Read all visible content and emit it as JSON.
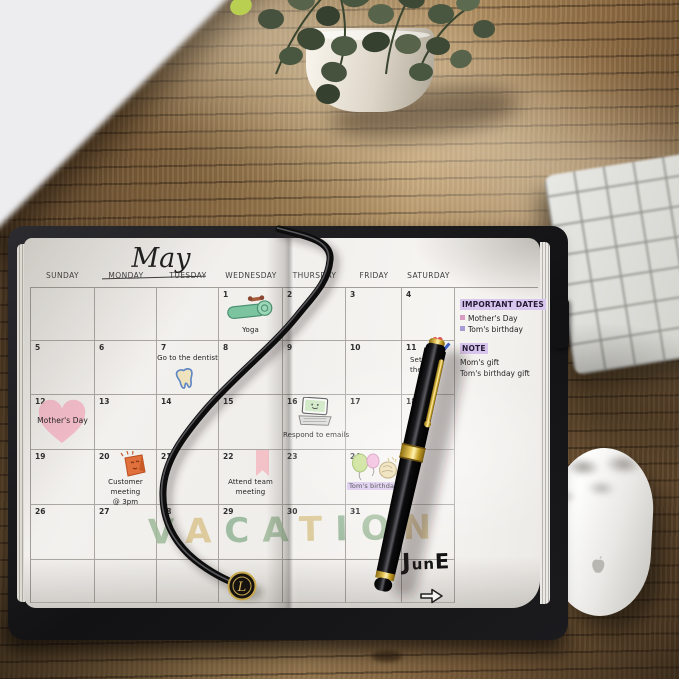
{
  "calendar": {
    "title": "May",
    "day_headers": [
      "SUNDAY",
      "MONDAY",
      "TUESDAY",
      "WEDNESDAY",
      "THURSDAY",
      "FRIDAY",
      "SATURDAY"
    ],
    "weeks": [
      [
        {
          "day": ""
        },
        {
          "day": ""
        },
        {
          "day": ""
        },
        {
          "day": "1",
          "note": "Yoga"
        },
        {
          "day": "2"
        },
        {
          "day": "3"
        },
        {
          "day": "4"
        }
      ],
      [
        {
          "day": "5"
        },
        {
          "day": "6"
        },
        {
          "day": "7",
          "note": "Go to the dentist"
        },
        {
          "day": "8"
        },
        {
          "day": "9"
        },
        {
          "day": "10"
        },
        {
          "day": "11",
          "note": "Set g",
          "note2": "the"
        }
      ],
      [
        {
          "day": "12",
          "note": "Mother's Day"
        },
        {
          "day": "13"
        },
        {
          "day": "14"
        },
        {
          "day": "15"
        },
        {
          "day": "16",
          "note": "Respond to emails"
        },
        {
          "day": "17"
        },
        {
          "day": "18"
        }
      ],
      [
        {
          "day": "19"
        },
        {
          "day": "20",
          "note": "Customer meeting",
          "note2": "@ 3pm"
        },
        {
          "day": "21"
        },
        {
          "day": "22",
          "note": "Attend team",
          "note2": "meeting"
        },
        {
          "day": "23"
        },
        {
          "day": "24",
          "note": "Tom's birthday"
        },
        {
          "day": "25"
        }
      ],
      [
        {
          "day": "26"
        },
        {
          "day": "27"
        },
        {
          "day": "28"
        },
        {
          "day": "29"
        },
        {
          "day": "30"
        },
        {
          "day": "31"
        },
        {
          "day": ""
        }
      ]
    ],
    "vacation_letters": [
      "V",
      "A",
      "C",
      "A",
      "T",
      "I",
      "O",
      "N"
    ],
    "june_letters": [
      "J",
      "u",
      "n",
      "E"
    ]
  },
  "sidebar": {
    "title": "IMPORTANT DATES",
    "important_dates": [
      "Mother's Day",
      "Tom's birthday"
    ],
    "note_title": "NOTE",
    "notes": [
      "Mom's gift",
      "Tom's birthday gift"
    ]
  },
  "charm": {
    "letter": "L"
  },
  "colors": {
    "highlight_lavender": "#d9c6ee",
    "heart_pink": "#f4b9c7",
    "vacation_green": "#9cb998",
    "vacation_tan": "#d9c48c"
  }
}
